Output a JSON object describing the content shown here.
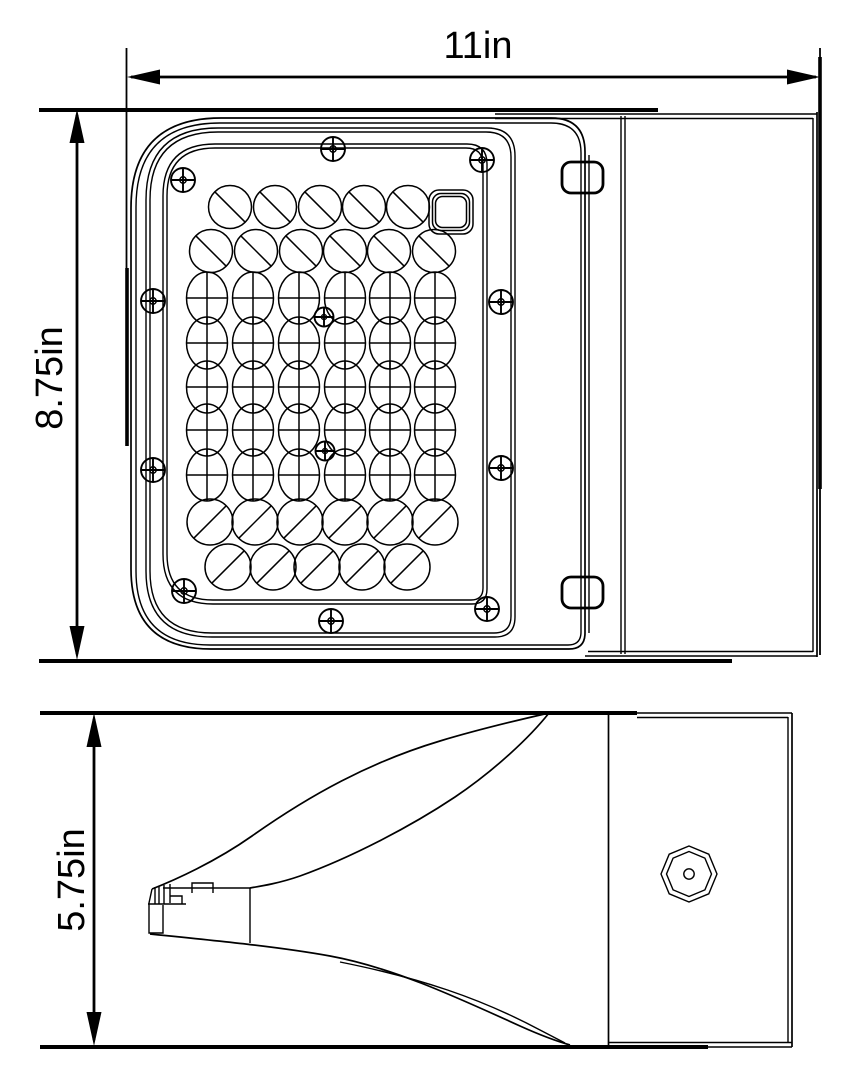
{
  "colors": {
    "line": "#000000",
    "background": "#ffffff"
  },
  "dimensions": {
    "width": {
      "label": "11in"
    },
    "height": {
      "label": "8.75in"
    },
    "depth": {
      "label": "5.75in"
    }
  },
  "front_view": {
    "led_array": {
      "rows": [
        {
          "y": 207,
          "type": "slash-down",
          "x": [
            230,
            275,
            320,
            364,
            408
          ]
        },
        {
          "y": 251,
          "type": "slash-down",
          "x": [
            211,
            256,
            301,
            345,
            389,
            434
          ]
        },
        {
          "y": 298,
          "type": "cross",
          "x": [
            207,
            253,
            299,
            345,
            390,
            435
          ]
        },
        {
          "y": 343,
          "type": "cross",
          "x": [
            207,
            253,
            299,
            345,
            390,
            435
          ]
        },
        {
          "y": 387,
          "type": "cross",
          "x": [
            207,
            253,
            299,
            345,
            390,
            435
          ]
        },
        {
          "y": 430,
          "type": "cross",
          "x": [
            207,
            253,
            299,
            345,
            390,
            435
          ]
        },
        {
          "y": 475,
          "type": "cross",
          "x": [
            207,
            253,
            299,
            345,
            390,
            435
          ]
        },
        {
          "y": 522,
          "type": "slash-up",
          "x": [
            210,
            255,
            300,
            345,
            390,
            435
          ]
        },
        {
          "y": 567,
          "type": "slash-up",
          "x": [
            228,
            273,
            317,
            362,
            407
          ]
        }
      ],
      "square_lens": {
        "x": 451,
        "y": 212
      }
    },
    "screws": {
      "perimeter": [
        [
          333,
          149
        ],
        [
          482,
          160
        ],
        [
          183,
          180
        ],
        [
          153,
          301
        ],
        [
          153,
          470
        ],
        [
          184,
          591
        ],
        [
          331,
          621
        ],
        [
          487,
          609
        ],
        [
          501,
          302
        ],
        [
          501,
          468
        ]
      ],
      "center": [
        [
          324,
          317
        ],
        [
          325,
          451
        ]
      ]
    }
  },
  "side_view": {
    "knockout": {
      "cx": 689,
      "cy": 874
    }
  }
}
